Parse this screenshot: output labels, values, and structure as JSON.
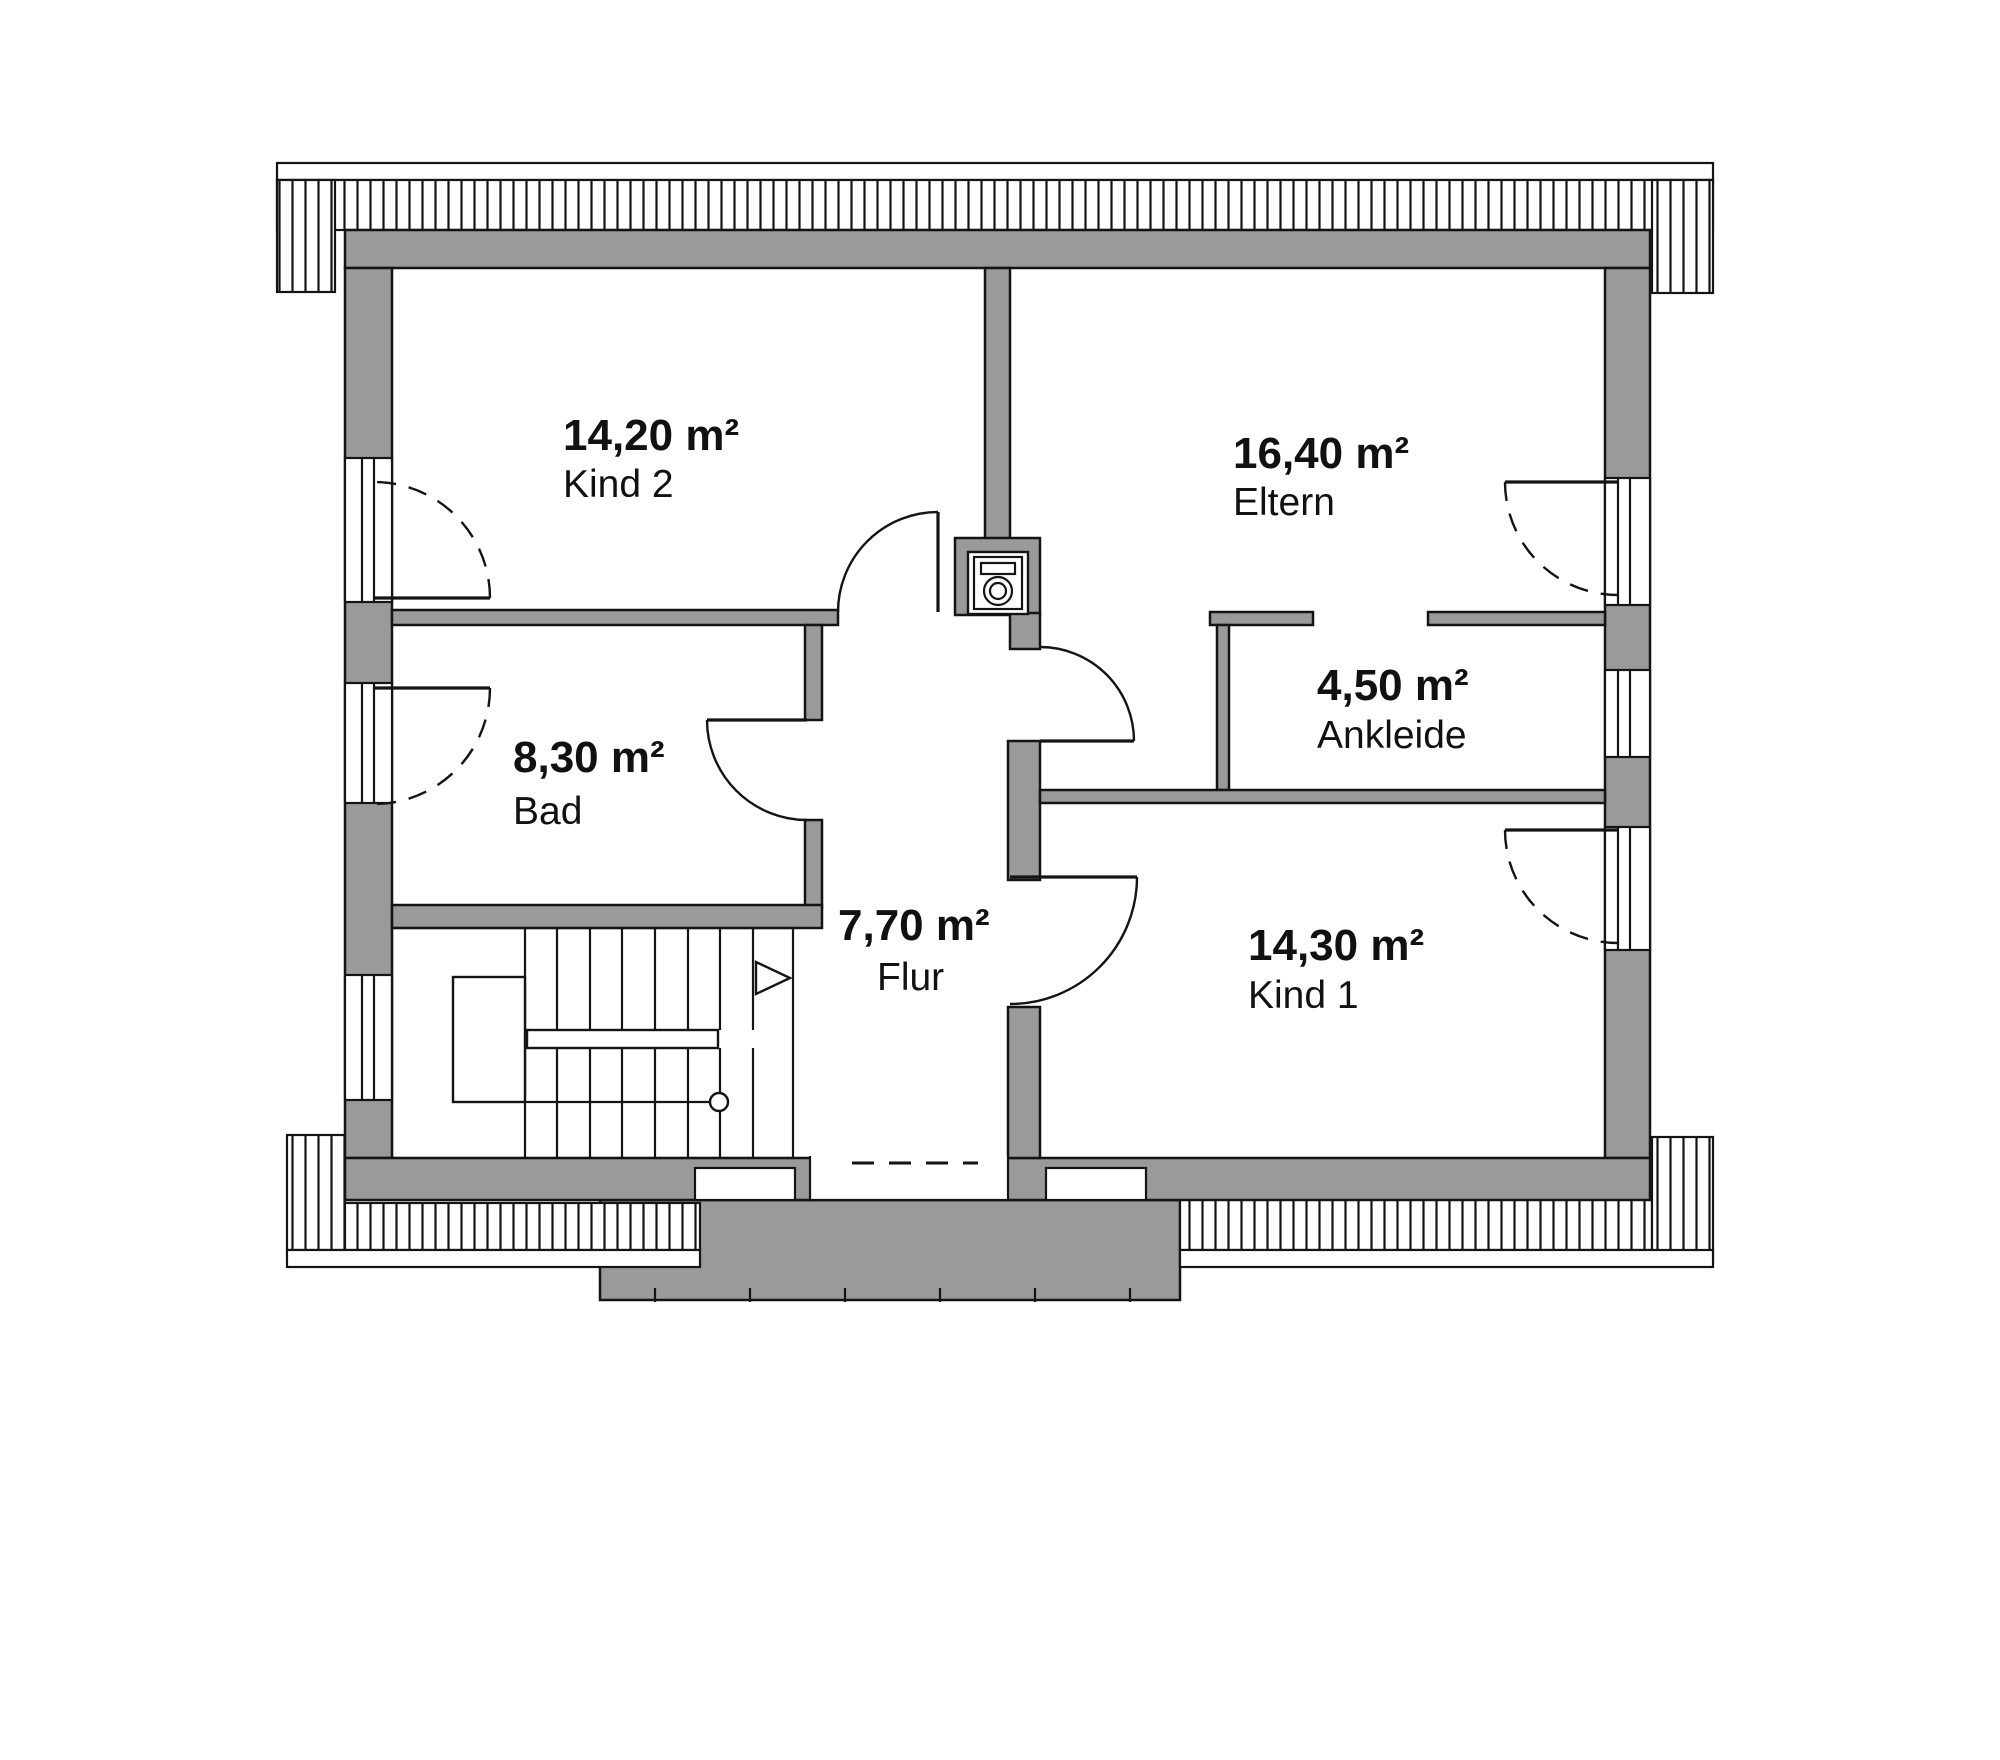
{
  "floorplan": {
    "rooms": [
      {
        "key": "kind2",
        "area": "14,20 m²",
        "label": "Kind 2"
      },
      {
        "key": "eltern",
        "area": "16,40 m²",
        "label": "Eltern"
      },
      {
        "key": "bad",
        "area": "8,30 m²",
        "label": "Bad"
      },
      {
        "key": "ankleide",
        "area": "4,50 m²",
        "label": "Ankleide"
      },
      {
        "key": "flur",
        "area": "7,70 m²",
        "label": "Flur"
      },
      {
        "key": "kind1",
        "area": "14,30 m²",
        "label": "Kind 1"
      }
    ],
    "colors": {
      "wall": "#9a9a9a",
      "outline": "#141414",
      "background": "#ffffff"
    }
  }
}
